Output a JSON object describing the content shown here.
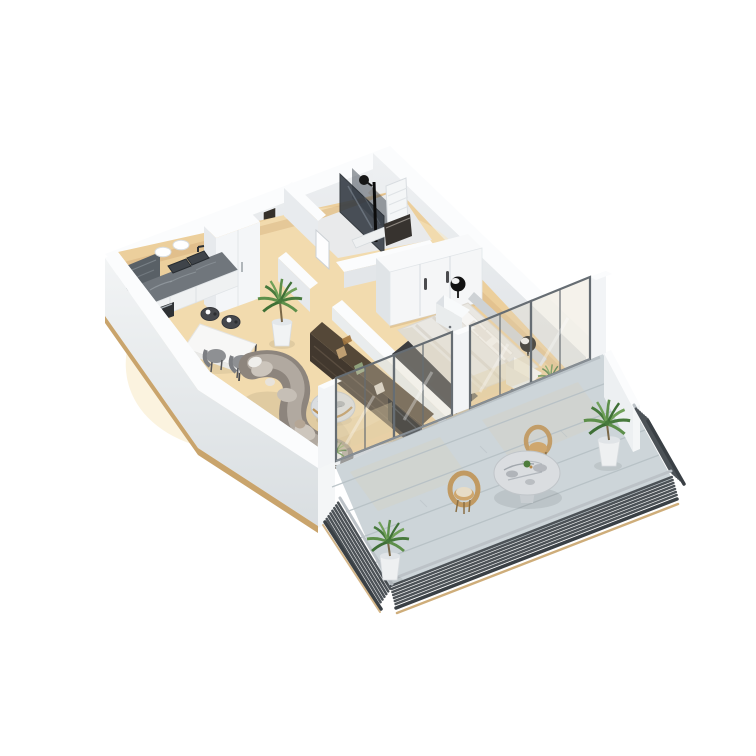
{
  "meta": {
    "type": "3d-isometric-floorplan-render",
    "view": "dollhouse-cutaway",
    "background": "#ffffff"
  },
  "palette": {
    "background": "#ffffff",
    "wall_top": "#fbfcfd",
    "wall_inner": "#e6e9ec",
    "wall_outer_light": "#f1f3f4",
    "wall_outer_deep": "#dde1e4",
    "plinth_wood": "#c9a46c",
    "floor_wood": "#eccf9c",
    "floor_wood_light": "#f7e7c0",
    "floor_shadow": "#c89c66",
    "bathroom_floor": "#e9eaeb",
    "shower_glass": "#323942",
    "backsplash_marble": "#596066",
    "counter_marble": "#70767c",
    "counter_front": "#eff1f2",
    "furniture_white": "#f5f6f7",
    "balcony_floor": "#cdd5d9",
    "balcony_plank_line": "#b6c0c5",
    "railing_dark": "#4c5257",
    "railing_cap": "#bcc2c7",
    "railing_skirt": "#3a4045",
    "glass_frame": "#666d73",
    "glass_tint": "#ded5bc",
    "sofa": "#8d857d",
    "sofa_light": "#b5ada4",
    "tv_unit": "#42382e",
    "tv_unit_top": "#554838",
    "marble_light": "#dadde0",
    "bed_mattress": "#e9e7e2",
    "bed_stripe": "#d8d3cb",
    "headboard": "#ced2d5",
    "rug_dark": "#34363a",
    "wicker": "#c19a62",
    "chair_gray": "#8e9093",
    "stool_dark": "#46484c",
    "lamp_black": "#121212",
    "plant_green": "#5d8f4a",
    "plant_green_dark": "#3f7036"
  },
  "scene": {
    "rooms": [
      {
        "name": "hallway",
        "items": [
          "entrance-door",
          "potted-palm"
        ]
      },
      {
        "name": "bathroom",
        "items": [
          "walk-in-shower",
          "black-shower-column",
          "towel-radiator",
          "dark-vanity",
          "door"
        ]
      },
      {
        "name": "kitchen",
        "items": [
          "marble-countertop",
          "double-sink",
          "faucet",
          "oven",
          "tall-cabinet",
          "wall-plates-2",
          "dark-backsplash"
        ]
      },
      {
        "name": "dining-area",
        "items": [
          "white-table",
          "gray-chairs-2",
          "dark-stools-2"
        ]
      },
      {
        "name": "living-room",
        "items": [
          "curved-sectional-sofa",
          "round-marble-coffee-table",
          "media-shelf-wall",
          "tv-screen",
          "small-palm"
        ]
      },
      {
        "name": "bedroom",
        "items": [
          "double-bed",
          "striped-duvet",
          "pillows-4",
          "headboard",
          "nightstands-2",
          "black-sphere-lamps-2",
          "wardrobe",
          "dark-rug",
          "potted-plant"
        ]
      },
      {
        "name": "balcony",
        "items": [
          "round-marble-table",
          "wicker-chairs-2",
          "potted-palms-2",
          "louvered-railing",
          "plank-decking",
          "glass-sliding-doors-4"
        ]
      }
    ],
    "counts": {
      "glass_door_panels": 4,
      "plants": 5,
      "sphere_lamps": 2,
      "railing_segments": 3
    }
  }
}
